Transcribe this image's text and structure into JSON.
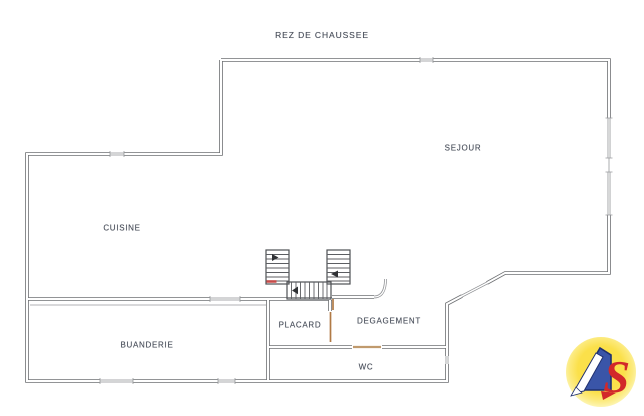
{
  "page": {
    "type": "scanned-floor-plan",
    "background": "#ffffff"
  },
  "title": "REZ DE CHAUSSEE",
  "rooms": {
    "sejour": {
      "label": "SEJOUR"
    },
    "cuisine": {
      "label": "CUISINE"
    },
    "buanderie": {
      "label": "BUANDERIE"
    },
    "placard": {
      "label": "PLACARD"
    },
    "degagement": {
      "label": "DEGAGEMENT"
    },
    "wc": {
      "label": "WC"
    }
  },
  "features": {
    "staircase": "double-flight-stair-with-landing",
    "doors": [
      "placard-door",
      "wc-door",
      "degagement-swing-door",
      "diagonal-entry-door"
    ],
    "windows": [
      "top-wall-window",
      "right-wall-windows",
      "left-upper-wall-window",
      "bottom-wall-windows"
    ]
  },
  "drawing_colors": {
    "wall": "#6e7073",
    "window": "#8d8f92",
    "door_leaf": "#b07a45",
    "stair_mark_red": "#c9413f",
    "label_text": "#474d59"
  },
  "logo": {
    "name": "4S",
    "letter": "S",
    "colors": {
      "circle_center": "#fbe14a",
      "circle_rim": "#fdf6b8",
      "four_fill": "#3a55a8",
      "four_outline": "#20306f",
      "s_red": "#d2282a"
    }
  }
}
